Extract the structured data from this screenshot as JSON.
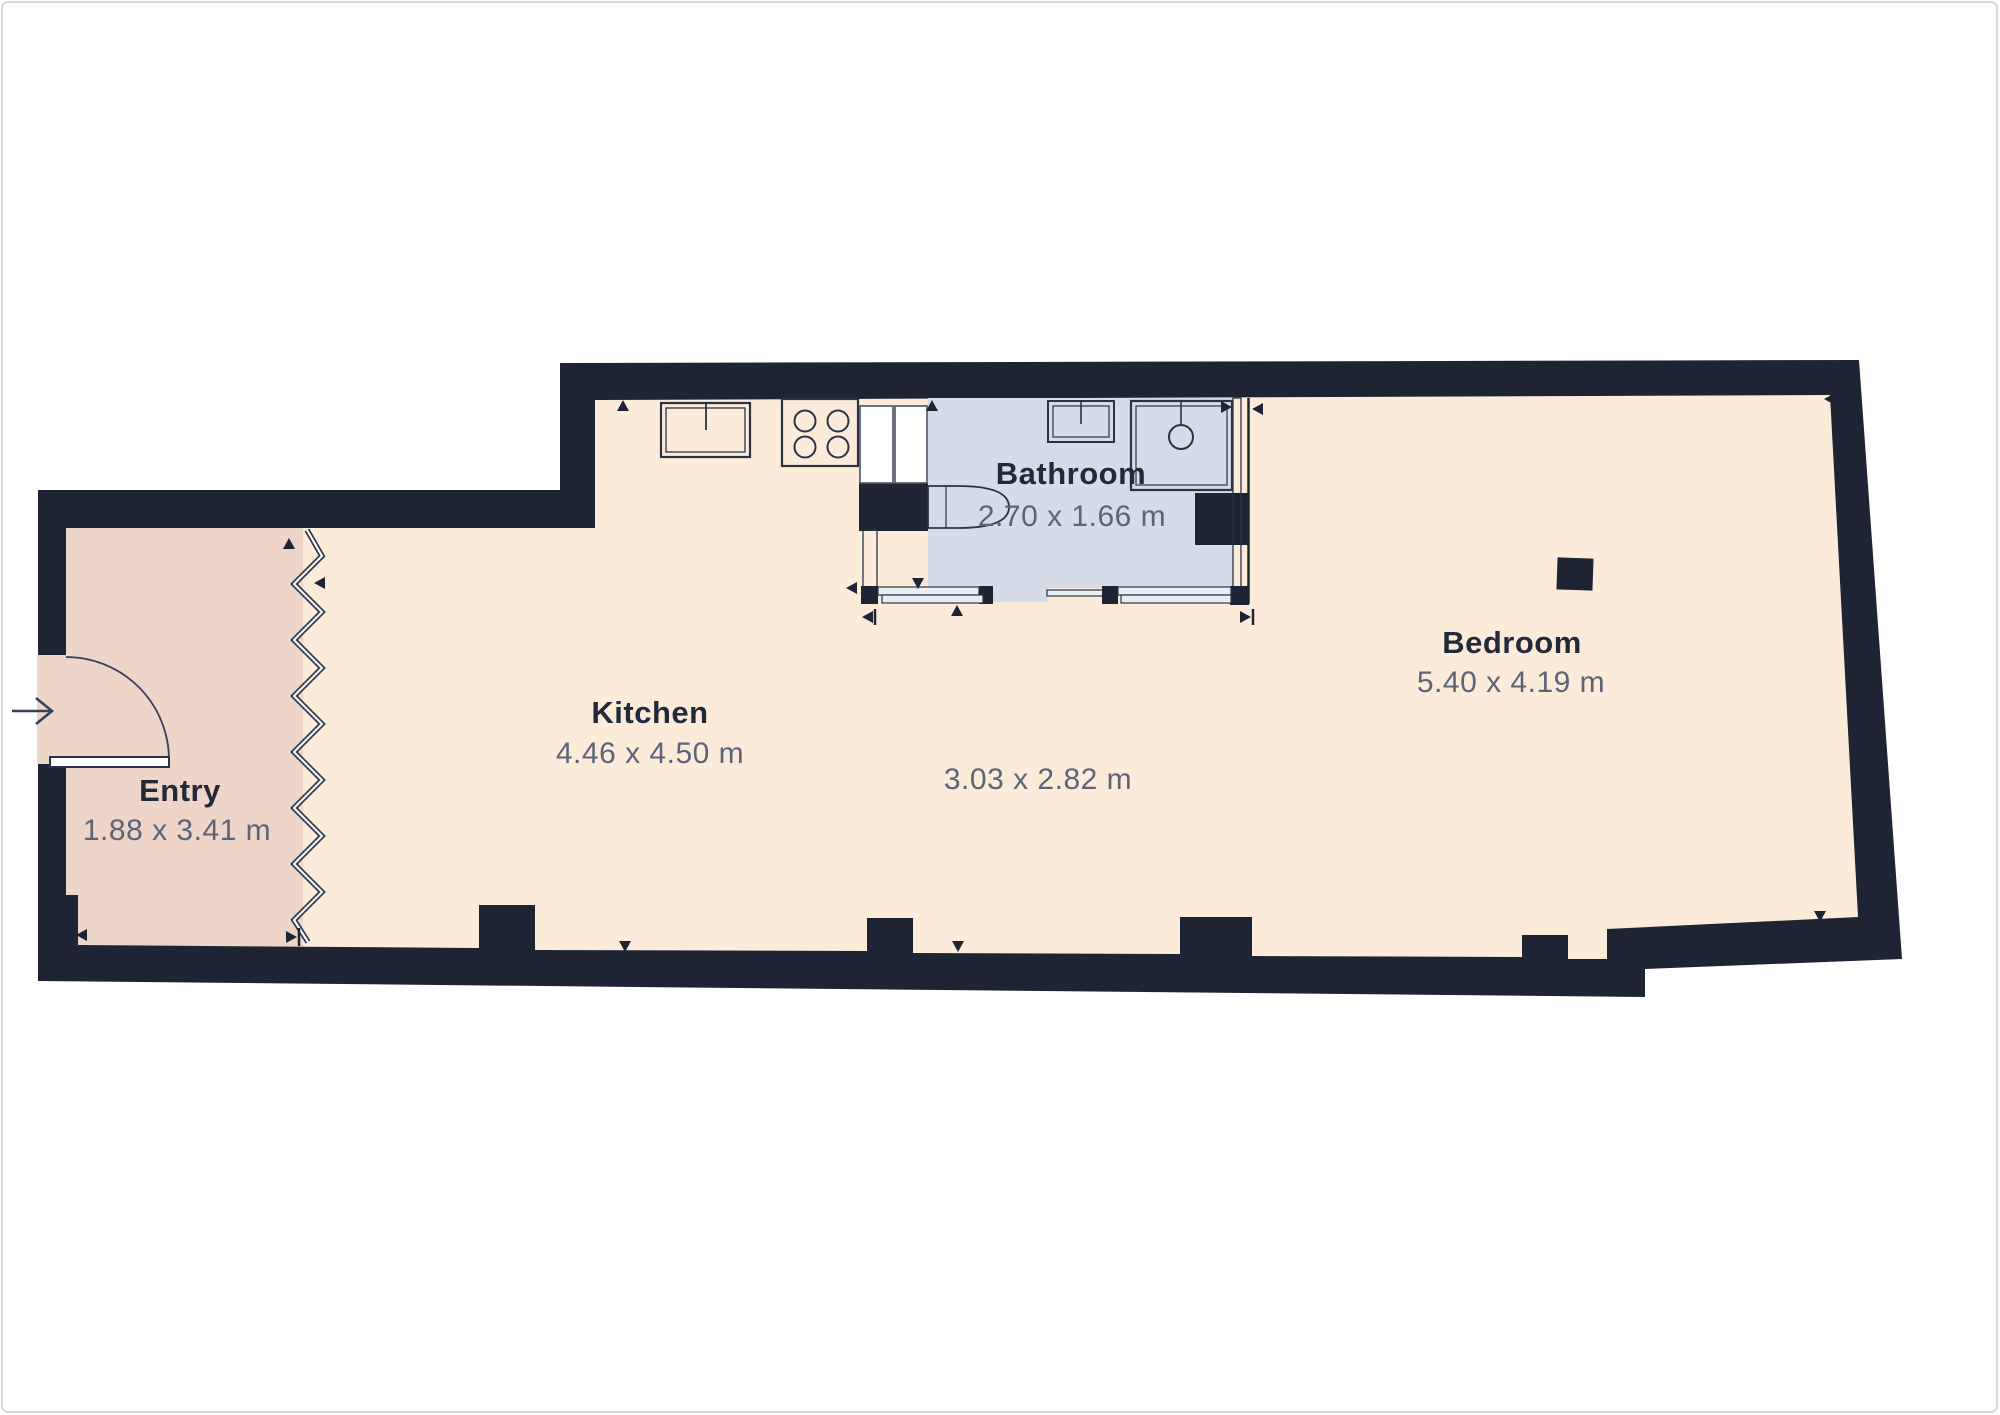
{
  "canvas": {
    "background": "#ffffff",
    "border_color": "#d6d8dc"
  },
  "floorplan": {
    "wall_color": "#1e2433",
    "room_label_color": "#222939",
    "dimension_label_color": "#5c6578",
    "rooms": [
      {
        "name": "Entry",
        "dimensions": "1.88 x 3.41 m",
        "floor_color": "#edd5c8"
      },
      {
        "name": "Kitchen",
        "dimensions": "4.46 x 4.50 m",
        "floor_color": "#fdebda"
      },
      {
        "name": "Bathroom",
        "dimensions": "2.70 x 1.66 m",
        "floor_color": "#d5dbe7"
      },
      {
        "name": "",
        "dimensions": "3.03 x 2.82 m",
        "floor_color": "#fdebda"
      },
      {
        "name": "Bedroom",
        "dimensions": "5.40 x 4.19 m",
        "floor_color": "#fdebda"
      }
    ],
    "fixtures": [
      "entry-door",
      "entry-direction-arrow",
      "stairs-divider-zigzag",
      "kitchen-sink",
      "cooktop-4-burners",
      "tall-cabinet",
      "bathroom-sink",
      "shower",
      "toilet",
      "sliding-door-left",
      "sliding-door-right",
      "open-door-leaf",
      "structural-column"
    ]
  }
}
